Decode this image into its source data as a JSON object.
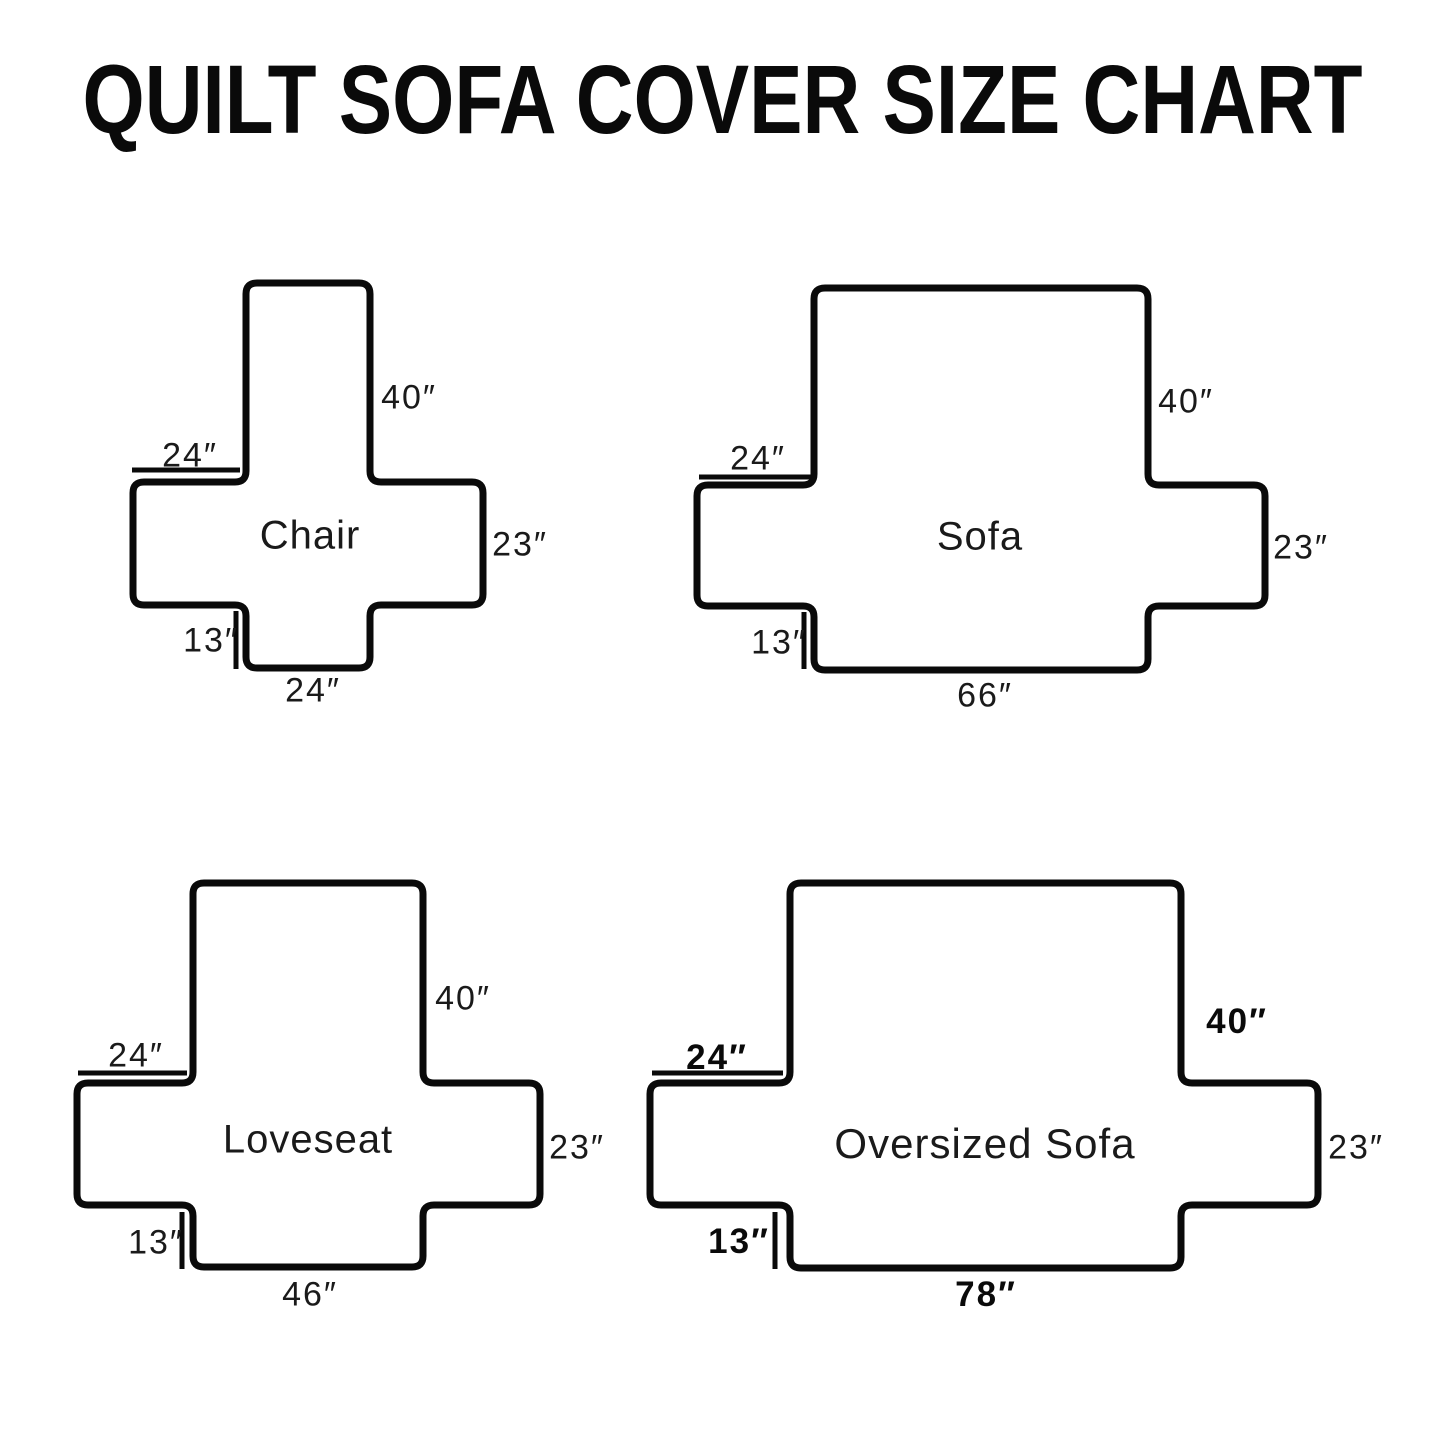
{
  "title": "QUILT SOFA COVER SIZE CHART",
  "colors": {
    "outline": "#0a0a0a",
    "background": "#ffffff",
    "text": "#111111"
  },
  "diagrams": {
    "chair": {
      "name": "Chair",
      "back_height": "40″",
      "arm_width": "24″",
      "side_height": "23″",
      "skirt_height": "13″",
      "bottom_width": "24″"
    },
    "sofa": {
      "name": "Sofa",
      "back_height": "40″",
      "arm_width": "24″",
      "side_height": "23″",
      "skirt_height": "13″",
      "bottom_width": "66″"
    },
    "loveseat": {
      "name": "Loveseat",
      "back_height": "40″",
      "arm_width": "24″",
      "side_height": "23″",
      "skirt_height": "13″",
      "bottom_width": "46″"
    },
    "oversized_sofa": {
      "name": "Oversized Sofa",
      "back_height": "40″",
      "arm_width": "24″",
      "side_height": "23″",
      "skirt_height": "13″",
      "bottom_width": "78″"
    }
  }
}
